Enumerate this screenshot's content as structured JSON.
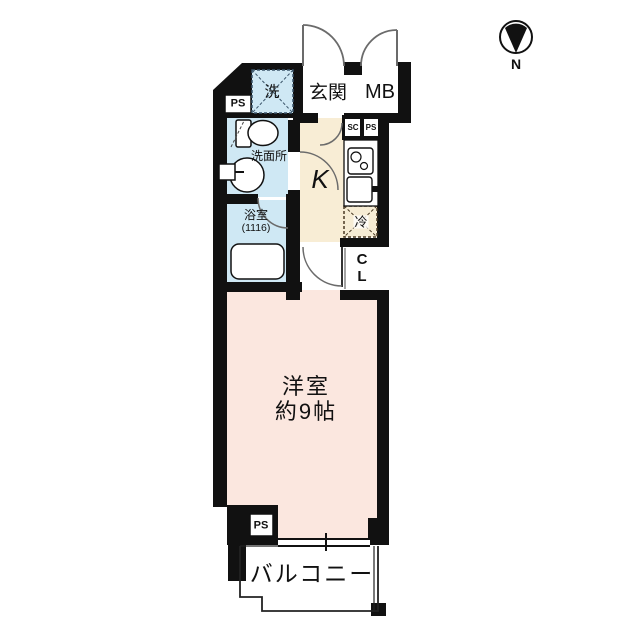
{
  "compass": {
    "north_label": "N"
  },
  "plan": {
    "top": {
      "pipe_space": "PS",
      "laundry": "洗",
      "entrance": "玄関",
      "meter_box": "MB"
    },
    "kitchen": {
      "label": "K",
      "shoe_closet": "SC",
      "pipe_space": "PS",
      "refrigerator": "冷"
    },
    "sanitary": {
      "washroom": "洗面所",
      "bathroom": "浴室",
      "bathroom_size": "(1116)"
    },
    "closet": {
      "line1": "C",
      "line2": "L"
    },
    "main_room": {
      "name": "洋室",
      "size": "約9帖"
    },
    "bottom": {
      "pipe_space": "PS",
      "balcony": "バルコニー"
    }
  },
  "colors": {
    "wall": "#111111",
    "floor_pink": "#fbe7df",
    "floor_cream": "#f8edd5",
    "floor_blue": "#cfe8f4",
    "fridge_bg": "#f6ecd4",
    "fridge_dash": "#4a3a24",
    "laundry_dash": "#3c566b",
    "arc": "#6b6b6b"
  }
}
